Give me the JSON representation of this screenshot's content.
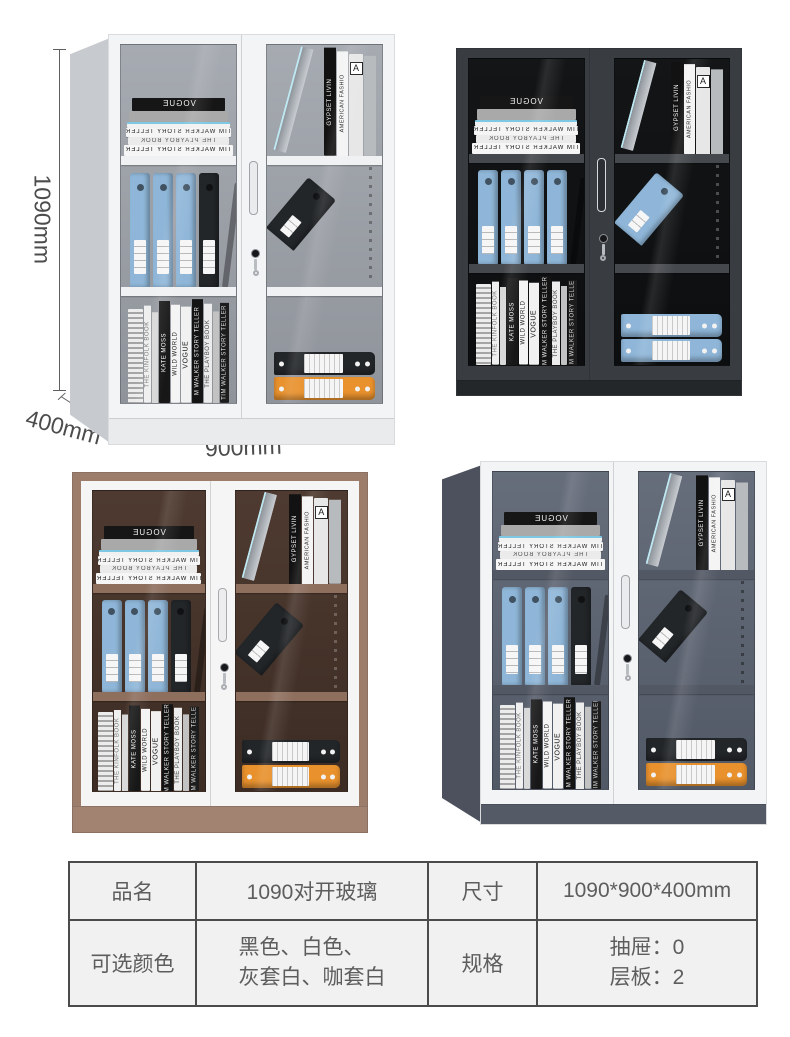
{
  "page": {
    "background": "#ffffff"
  },
  "annotations": {
    "height_label": "1090mm",
    "depth_label": "400mm",
    "width_label": "900mm",
    "line_color": "#606060",
    "text_color": "#4c4c4c"
  },
  "book_text": {
    "vogue": "VOGUE",
    "tim_walker": "TIM WALKER STORY TELLER",
    "playboy": "THE PLAYBOY BOOK",
    "kinfolk": "THE KINFOLK BOOK",
    "kate_moss": "KATE MOSS",
    "wild_world": "WILD WORLD",
    "m_walker": "M WALKER STORY TELLER",
    "gypset": "GYPSET LIVIN",
    "american": "AMERICAN FASHIO",
    "a_mark": "A"
  },
  "palette": {
    "binder_blue": "#8fb6d8",
    "binder_black": "#232629",
    "binder_orange": "#e8912d",
    "label_white": "#f5f5f5"
  },
  "cabinets": [
    {
      "key": "white",
      "color_name": "白色",
      "perspective": true,
      "colors": {
        "side": "#c7cacf",
        "frame": "#f3f4f6",
        "interior": "#a6aab1",
        "interior_deep": "#8f939a",
        "shelf": "#f0f1f3",
        "base": "#e9ebed",
        "handle": "#eaebec",
        "handle_edge": "#9fa2a6",
        "rail": "rgba(50,50,50,0.45)"
      },
      "content": {
        "mid_binders": [
          "blue",
          "blue",
          "blue",
          "black"
        ],
        "tilted": "black",
        "bottom_binders": [
          "black",
          "orange"
        ]
      }
    },
    {
      "key": "black",
      "color_name": "黑色",
      "perspective": false,
      "colors": {
        "frame": "#393c40",
        "interior": "#131517",
        "interior_deep": "#0c0e10",
        "shelf": "#45484c",
        "base": "#24272a",
        "handle": "#2c2f33",
        "handle_edge": "#d7dadd",
        "rail": "rgba(255,255,255,0.25)"
      },
      "content": {
        "mid_binders": [
          "blue",
          "blue",
          "blue",
          "blue"
        ],
        "tilted": "blue",
        "bottom_binders": [
          "blue",
          "blue"
        ]
      }
    },
    {
      "key": "brown",
      "color_name": "咖套白",
      "perspective": false,
      "colors": {
        "outer": "#9c7d6c",
        "frame": "#f5f5f6",
        "interior": "#4e3a30",
        "interior_deep": "#3c2c24",
        "shelf": "#8e6f5e",
        "base": "#a28372",
        "handle": "#ededee",
        "handle_edge": "#a8abae",
        "rail": "rgba(255,255,255,0.22)"
      },
      "content": {
        "mid_binders": [
          "blue",
          "blue",
          "blue",
          "black"
        ],
        "tilted": "black",
        "bottom_binders": [
          "black",
          "orange"
        ]
      }
    },
    {
      "key": "gray",
      "color_name": "灰套白",
      "perspective": true,
      "colors": {
        "side": "#4c515d",
        "frame": "#f3f4f6",
        "interior": "#666d7b",
        "interior_deep": "#525966",
        "shelf": "#525864",
        "base": "#545a66",
        "handle": "#eaebec",
        "handle_edge": "#9fa2a6",
        "rail": "rgba(15,15,15,0.45)"
      },
      "content": {
        "mid_binders": [
          "blue",
          "blue",
          "blue",
          "black"
        ],
        "tilted": "black",
        "bottom_binders": [
          "black",
          "orange"
        ]
      }
    }
  ],
  "spec_table": {
    "border_color": "#4b4b4b",
    "background": "#f1f1f2",
    "text_color": "#5d5d5d",
    "rows": [
      {
        "cells": [
          {
            "t": "品名"
          },
          {
            "t": "1090对开玻璃"
          },
          {
            "t": "尺寸"
          },
          {
            "t": "1090*900*400mm"
          }
        ]
      },
      {
        "cells": [
          {
            "t": "可选颜色"
          },
          {
            "lines": [
              "黑色、白色、",
              "灰套白、咖套白"
            ]
          },
          {
            "t": "规格"
          },
          {
            "lines": [
              "抽屉：0",
              "层板：2"
            ]
          }
        ]
      }
    ]
  }
}
